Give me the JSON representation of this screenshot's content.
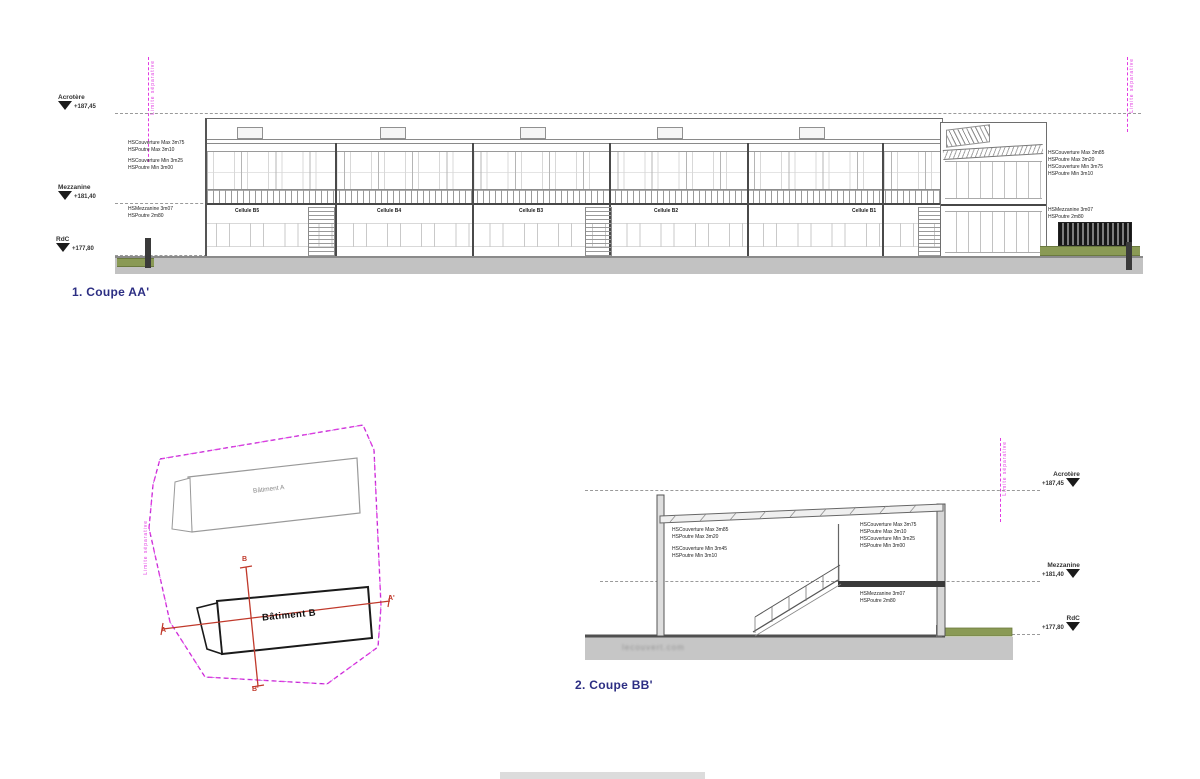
{
  "titles": {
    "section_1": "1. Coupe AA'",
    "section_2": "2. Coupe BB'"
  },
  "levels": [
    {
      "name": "Acrotère",
      "value": "+187,45"
    },
    {
      "name": "Mezzanine",
      "value": "+181,40"
    },
    {
      "name": "RdC",
      "value": "+177,80"
    }
  ],
  "boundary_label": "Limite séparative",
  "section_aa": {
    "cells": [
      "Cellule B5",
      "Cellule B4",
      "Cellule B3",
      "Cellule B2",
      "Cellule B1"
    ],
    "ann_left": [
      "HSCouverture Max 3m75",
      "HSPoutre Max 3m10",
      "HSCouverture Min 3m25",
      "HSPoutre Min 3m00"
    ],
    "ann_left_mezz": [
      "HSMezzanine 3m07",
      "HSPoutre 2m80"
    ],
    "ann_right": [
      "HSCouverture Max 3m85",
      "HSPoutre Max 3m20",
      "HSCouverture Min 3m75",
      "HSPoutre Min 3m10"
    ],
    "ann_right_mezz": [
      "HSMezzanine 3m07",
      "HSPoutre 2m80"
    ]
  },
  "section_bb": {
    "ann_left": [
      "HSCouverture Max 3m85",
      "HSPoutre Max 3m20",
      "HSCouverture Min 3m45",
      "HSPoutre Min 3m10"
    ],
    "ann_right": [
      "HSCouverture Max 3m75",
      "HSPoutre Max 3m10",
      "HSCouverture Min 3m25",
      "HSPoutre Min 3m00"
    ],
    "ann_right_mezz": [
      "HSMezzanine 3m07",
      "HSPoutre 2m80"
    ],
    "watermark": "lecouvert.com"
  },
  "site_plan": {
    "building_a": "Bâtiment A",
    "building_b": "Bâtiment B",
    "mark_a": "A",
    "mark_a_prime": "A'",
    "mark_b": "B",
    "mark_b_prime": "B'"
  },
  "colors": {
    "magenta": "#e23ae2",
    "red": "#c0392b",
    "navy": "#2c2e83",
    "green": "#8a9a55",
    "ground": "#c2c2c2",
    "line": "#666666"
  }
}
